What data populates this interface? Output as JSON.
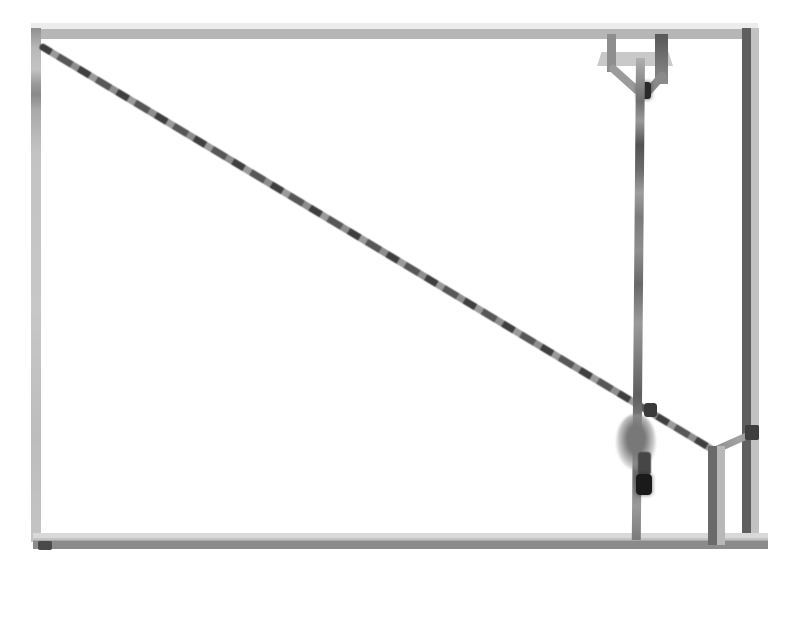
{
  "diagram": {
    "type": "scanned-line-drawing",
    "description": "Hand-drawn rectangle with a diagonal cable from the top-left corner to a lower-right junction, a pulley bracket hanging from the top edge with a vertical rope, a fuzzy weight and a dark bead on the rope, and a short vertical post tied to the right wall at the lower right.",
    "frame": {
      "left": 33,
      "top": 25,
      "right": 758,
      "bottom": 545
    },
    "elements": [
      {
        "name": "diagonal-cable",
        "from": [
          40,
          42
        ],
        "to": [
          717,
          449
        ]
      },
      {
        "name": "pulley-bracket",
        "at": [
          638,
          34
        ],
        "arms": 2,
        "hub": [
          644,
          90
        ]
      },
      {
        "name": "hanging-rope",
        "from": [
          640,
          58
        ],
        "to": [
          644,
          540
        ]
      },
      {
        "name": "rope-knot",
        "at": [
          650,
          410
        ]
      },
      {
        "name": "weight-blob",
        "at": [
          636,
          442
        ]
      },
      {
        "name": "weight-bead",
        "at": [
          644,
          484
        ]
      },
      {
        "name": "support-post",
        "from": [
          716,
          446
        ],
        "to": [
          716,
          545
        ]
      },
      {
        "name": "tie-line",
        "from": [
          716,
          450
        ],
        "to": [
          757,
          432
        ]
      },
      {
        "name": "wall-anchor-spot",
        "at": [
          752,
          432
        ]
      }
    ]
  },
  "colors": {
    "paper": "#ffffff",
    "frame-light": "#ececec",
    "frame-gray": "#b6b6b6",
    "frame-mid": "#c4c4c4",
    "frame-dark": "#6e6e6e",
    "pencil-dark": "#3f3f3f",
    "pencil-mid": "#6a6a6a",
    "pencil-soft": "#9a9a9a",
    "ink-black": "#1a1a1a"
  }
}
